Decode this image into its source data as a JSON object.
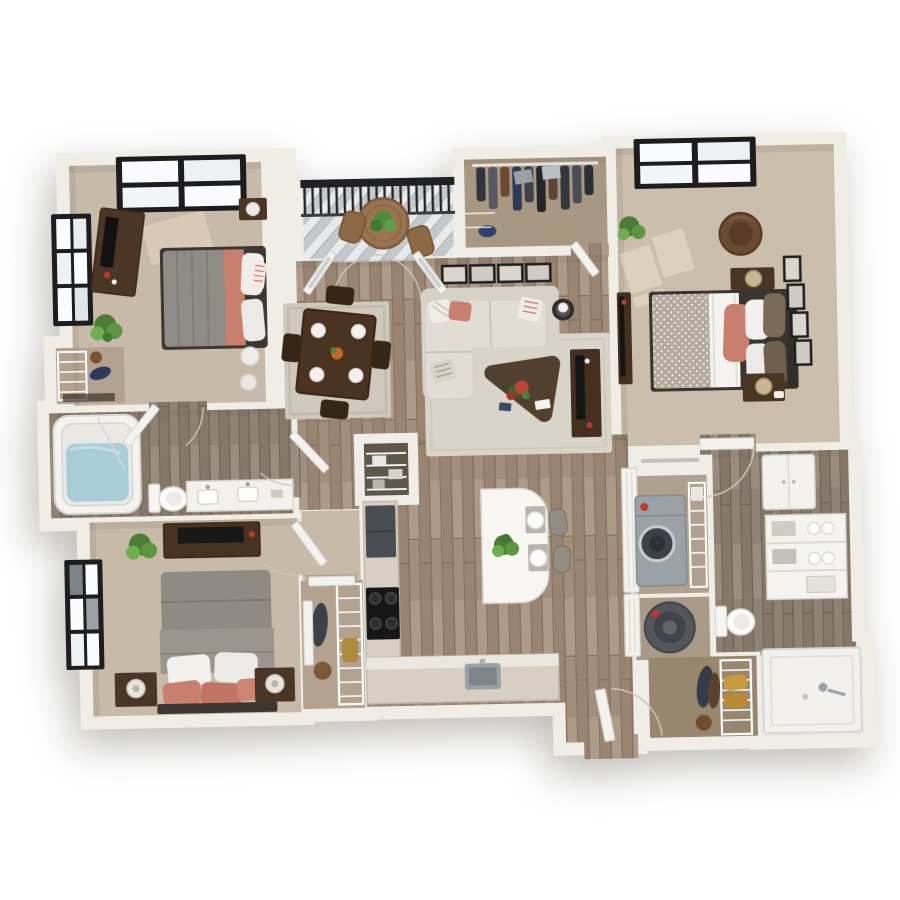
{
  "scene": {
    "type": "3d-floor-plan-render",
    "description": "Top-down 3D rendering of an apartment floor plan on a plain white background; no text or UI controls are visible",
    "background": "#ffffff"
  },
  "palette": {
    "wall": "#f0ede6",
    "wood_floor": "#a3907f",
    "bath_floor": "#8f8274",
    "carpet": "#c8baa8",
    "carpet_bedroom2": "#ccbeac",
    "closet_floor": "#b3a28f",
    "pantry_floor": "#5f574c",
    "deck_gray": "#c3c6c9",
    "accent_coral": "#c87f6e",
    "sofa_cream": "#dedad0",
    "dark_wood": "#4b3626",
    "window_frame": "#1d1d20",
    "railing_black": "#202124",
    "plant_green": "#579540",
    "tub_water": "#a9cdd7",
    "appliance_gray": "#9aa2a8",
    "gold_towel": "#c79a3e",
    "red_knob": "#c0392b"
  },
  "rooms": [
    {
      "id": "bedroom-1",
      "label": "Bedroom 1 (top left)",
      "floor": "carpet",
      "furniture": [
        "queen bed with gray duvet, coral throw and white pillows",
        "dark media dresser with tv and red vase",
        "nightstand with lamp",
        "round pouf and stool",
        "potted plant",
        "reach-in closet with wire shelving",
        "black-framed picture window on top wall",
        "black-framed window on left wall"
      ]
    },
    {
      "id": "balcony",
      "label": "Balcony",
      "floor": "gray deck boards",
      "furniture": [
        "black metal railing",
        "round wood bistro table with potted plant",
        "two patio chairs"
      ]
    },
    {
      "id": "wardrobe",
      "label": "Walk-in wardrobe (top center)",
      "floor": "closet carpet",
      "furniture": [
        "hanging rod with dark clothes",
        "gray storage boxes",
        "blue bag",
        "wire shelving"
      ]
    },
    {
      "id": "bedroom-2",
      "label": "Bedroom 2 (top right)",
      "floor": "carpet",
      "furniture": [
        "queen bed with dotted duvet, white sheet, coral and taupe pillows",
        "two dark nightstands with woven lamps",
        "round leather chair",
        "slim tv console",
        "column of four wall frames",
        "potted plant",
        "black-framed window",
        "sunlight patches on floor"
      ]
    },
    {
      "id": "living-room",
      "label": "Living room",
      "floor": "wood planks",
      "furniture": [
        "cream l-shaped sectional with striped and coral pillows",
        "triangular dark coffee table with red plant and books",
        "light area rug",
        "glass side table with lamp",
        "dark media console with tv",
        "row of four framed pictures",
        "french doors to balcony"
      ]
    },
    {
      "id": "dining-area",
      "label": "Dining area",
      "floor": "wood planks",
      "furniture": [
        "dark wood dining table with four place settings and centerpiece",
        "four dark chairs",
        "bordered area rug"
      ]
    },
    {
      "id": "kitchen",
      "label": "Kitchen",
      "floor": "wood planks",
      "furniture": [
        "l-shaped counter",
        "dark refrigerator",
        "black range cooktop",
        "undermount sink with faucet",
        "white waterfall island with plant and two place settings",
        "two upholstered stools",
        "walk-in pantry with wire shelving and boxes"
      ]
    },
    {
      "id": "hallway-entry",
      "label": "Entry hall",
      "floor": "wood planks",
      "furniture": [
        "open front door with swing arc",
        "white double doors to laundry and utility closets"
      ]
    },
    {
      "id": "laundry-closet",
      "label": "Laundry closet",
      "floor": "closet carpet",
      "furniture": [
        "front-load washer/dryer with red knob",
        "wire shelf with supplies"
      ]
    },
    {
      "id": "utility-closet",
      "label": "Utility closet",
      "floor": "closet carpet",
      "furniture": [
        "cylindrical water heater"
      ]
    },
    {
      "id": "bathroom-1",
      "label": "Bathroom 1 (left)",
      "floor": "gray wood",
      "furniture": [
        "soaking tub filled with water",
        "toilet",
        "white double-sink vanity",
        "door from bedroom 1",
        "door from hallway"
      ]
    },
    {
      "id": "bedroom-3",
      "label": "Bedroom 3 (bottom left)",
      "floor": "carpet",
      "furniture": [
        "bed with tall gray headboard, white pillows and coral throw pillows",
        "two dark nightstands with lamps",
        "dark dresser with tv",
        "potted plant",
        "black-framed window on left wall",
        "walk-in closet with wire shelving and hanging clothes"
      ]
    },
    {
      "id": "bathroom-2",
      "label": "Bathroom 2 (right)",
      "floor": "gray wood",
      "furniture": [
        "white wall cabinet",
        "linen shelving with rolled towels and baskets",
        "toilet",
        "walk-in shower with chrome fixture",
        "door from bedroom 2"
      ]
    },
    {
      "id": "linen-closet",
      "label": "Bottom-right closet",
      "floor": "closet carpet",
      "furniture": [
        "wire shelving",
        "rolled gold towels",
        "hanging garments",
        "round hat box"
      ]
    }
  ]
}
